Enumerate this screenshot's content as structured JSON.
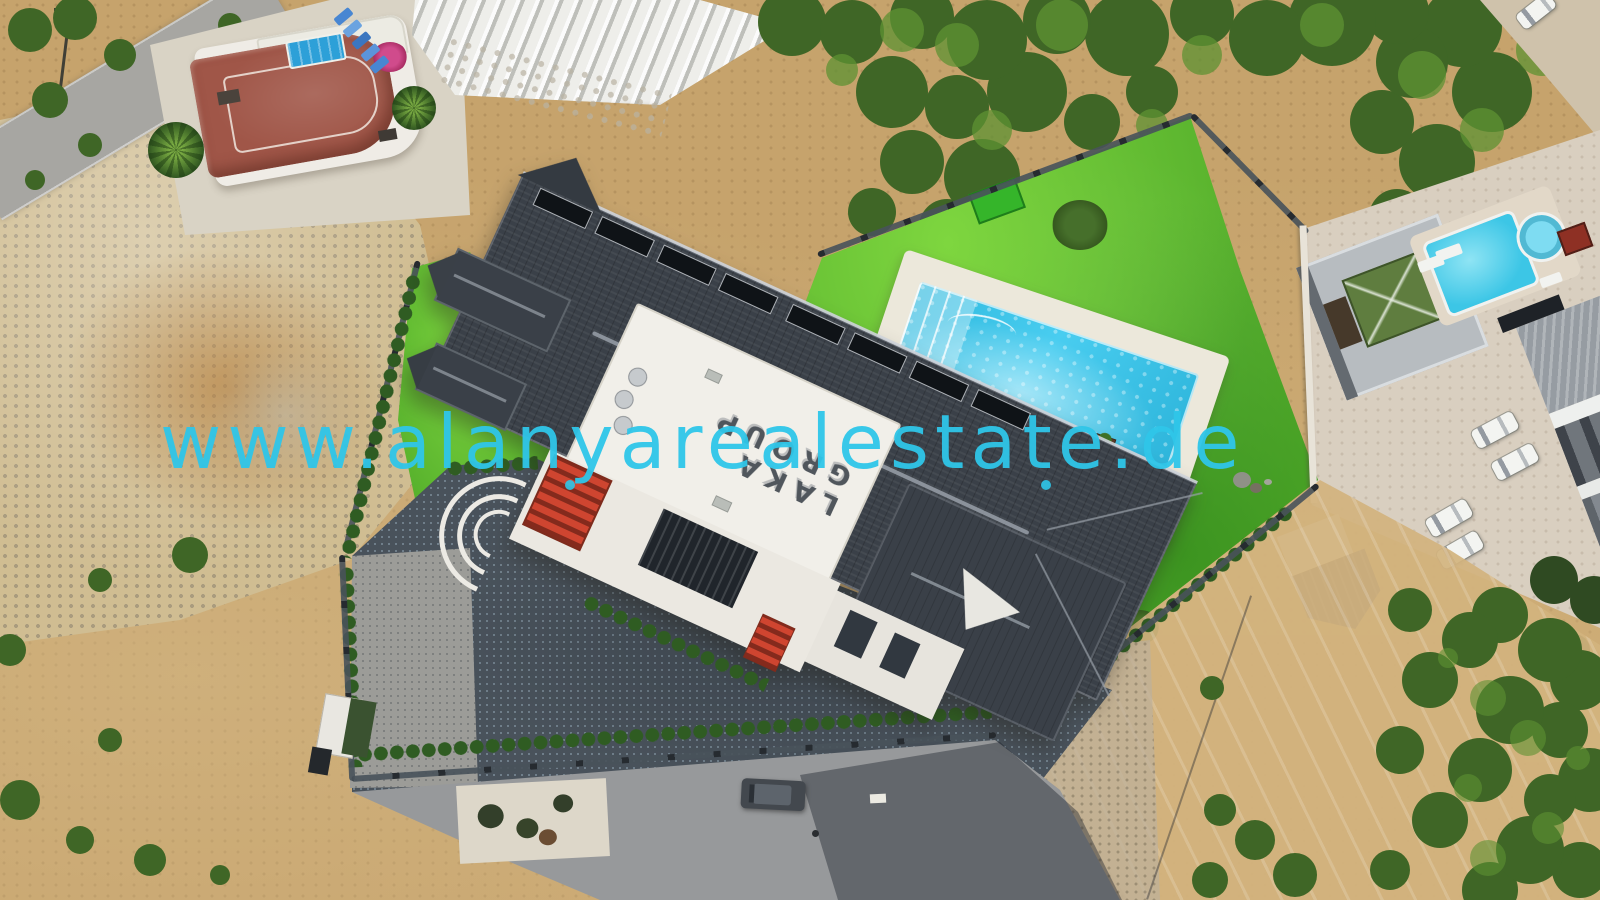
{
  "watermark": {
    "text": "www.alanyarealestate.de"
  },
  "building": {
    "rooftop_sign": "LAKA GROUP"
  },
  "palette": {
    "dirt": "#c6a36c",
    "dirt-light": "#d6c091",
    "lawn": "#56b02c",
    "lawn-light": "#7ed63f",
    "lawn-dark": "#3c9420",
    "tree": "#3f6626",
    "tree-light": "#5e9233",
    "pool-water": "#38c4e8",
    "pool-deck": "#ece8db",
    "roof-dark": "#3a4048",
    "roof-ridge": "#9aa1aa",
    "roof-edge": "#ced3d9",
    "terrace-white": "#f1efe9",
    "facade-white": "#ebe8e1",
    "facade-dark": "#20252b",
    "accent-red": "#cf4530",
    "cobble": "#49525b",
    "asphalt": "#97999b",
    "road-light": "#a7a6a2",
    "concrete": "#d9cfc0",
    "fence": "#262b30",
    "hedge": "#2f5c22",
    "terracotta": "#a05648",
    "house-white": "#efece6",
    "watermark": "#2fc6e9",
    "gazebo-green": "#5f7d3f",
    "bright-green": "#35b52a",
    "metal-gray": "#b7bcc0",
    "shed-gray": "#5b6166",
    "car-white": "#f3f4f1",
    "car-dark": "#43484e",
    "car-blue": "#4886d2",
    "magenta": "#c2347a"
  }
}
